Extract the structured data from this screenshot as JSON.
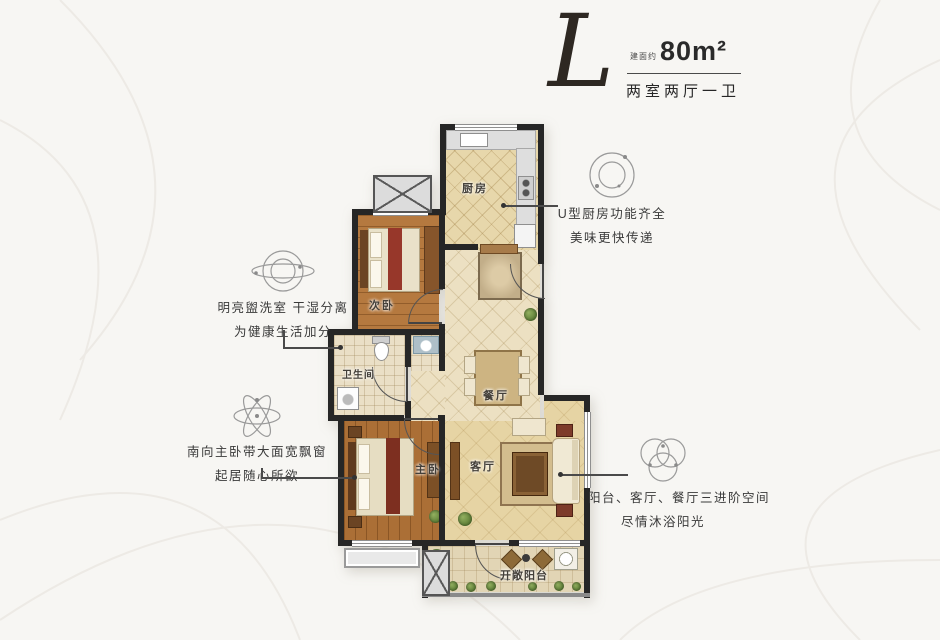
{
  "title": {
    "type_letter": "L",
    "area_prefix": "建面约",
    "area_value": "80m²",
    "layout_label": "两室两厅一卫"
  },
  "rooms": {
    "kitchen": "厨房",
    "second_bedroom": "次卧",
    "bathroom": "卫生间",
    "dining": "餐厅",
    "master_bedroom": "主卧",
    "living": "客厅",
    "balcony": "开敞阳台"
  },
  "annotations": {
    "kitchen_note": {
      "icon": "concentric-circles-icon",
      "line1": "U型厨房功能齐全",
      "line2": "美味更快传递"
    },
    "washroom_note": {
      "icon": "orbit-circles-icon",
      "line1": "明亮盥洗室 干湿分离",
      "line2": "为健康生活加分"
    },
    "master_note": {
      "icon": "atom-orbits-icon",
      "line1": "南向主卧带大面宽飘窗",
      "line2": "起居随心所欲"
    },
    "living_note": {
      "icon": "venn-circles-icon",
      "line1": "阳台、客厅、餐厅三进阶空间",
      "line2": "尽情沐浴阳光"
    }
  },
  "colors": {
    "wall": "#262626",
    "wood_floor": "#b5793f",
    "tile_floor": "#ece0c2",
    "kitchen_floor": "#e7d7ab",
    "text": "#3a3a3a",
    "background": "#f7f6f3"
  }
}
